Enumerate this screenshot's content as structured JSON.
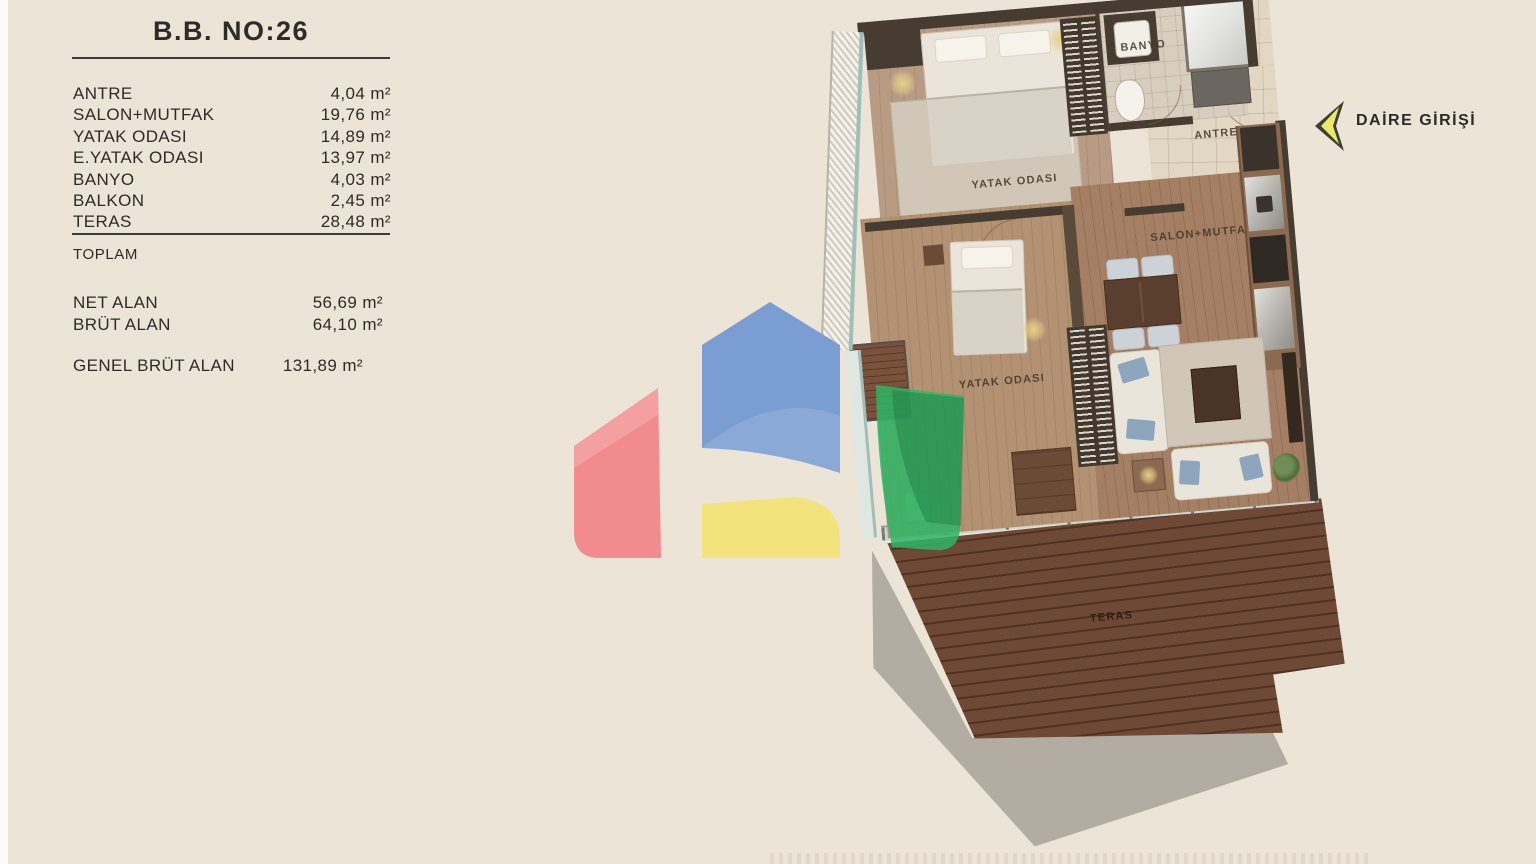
{
  "page": {
    "background": "#ece4d7",
    "text_color": "#2d2c29"
  },
  "info_panel": {
    "title": "B.B. NO:26",
    "rooms": [
      {
        "label": "ANTRE",
        "value": "4,04 m²"
      },
      {
        "label": "SALON+MUTFAK",
        "value": "19,76 m²"
      },
      {
        "label": "YATAK ODASI",
        "value": "14,89 m²"
      },
      {
        "label": "E.YATAK ODASI",
        "value": "13,97 m²"
      },
      {
        "label": "BANYO",
        "value": "4,03 m²"
      },
      {
        "label": "BALKON",
        "value": "2,45 m²"
      },
      {
        "label": "TERAS",
        "value": "28,48 m²"
      }
    ],
    "section_label": "TOPLAM",
    "totals": [
      {
        "label": "NET ALAN",
        "value": "56,69 m²"
      },
      {
        "label": "BRÜT ALAN",
        "value": "64,10 m²"
      }
    ],
    "grand_total": {
      "label": "GENEL BRÜT ALAN",
      "value": "131,89 m²"
    }
  },
  "floor_plan": {
    "labels": {
      "bedroom_top": "YATAK ODASI",
      "bathroom": "BANYO",
      "hall": "ANTRE",
      "living_kitchen": "SALON+MUTFAK",
      "bedroom_mid": "YATAK ODASI",
      "terrace": "TERAS"
    },
    "entrance_label": "DAİRE GİRİŞİ"
  },
  "logo": {
    "colors": {
      "red": "#f28b8e",
      "blue": "#7b9ed2",
      "yellow": "#f3e37c",
      "green": "#2eb566"
    }
  }
}
